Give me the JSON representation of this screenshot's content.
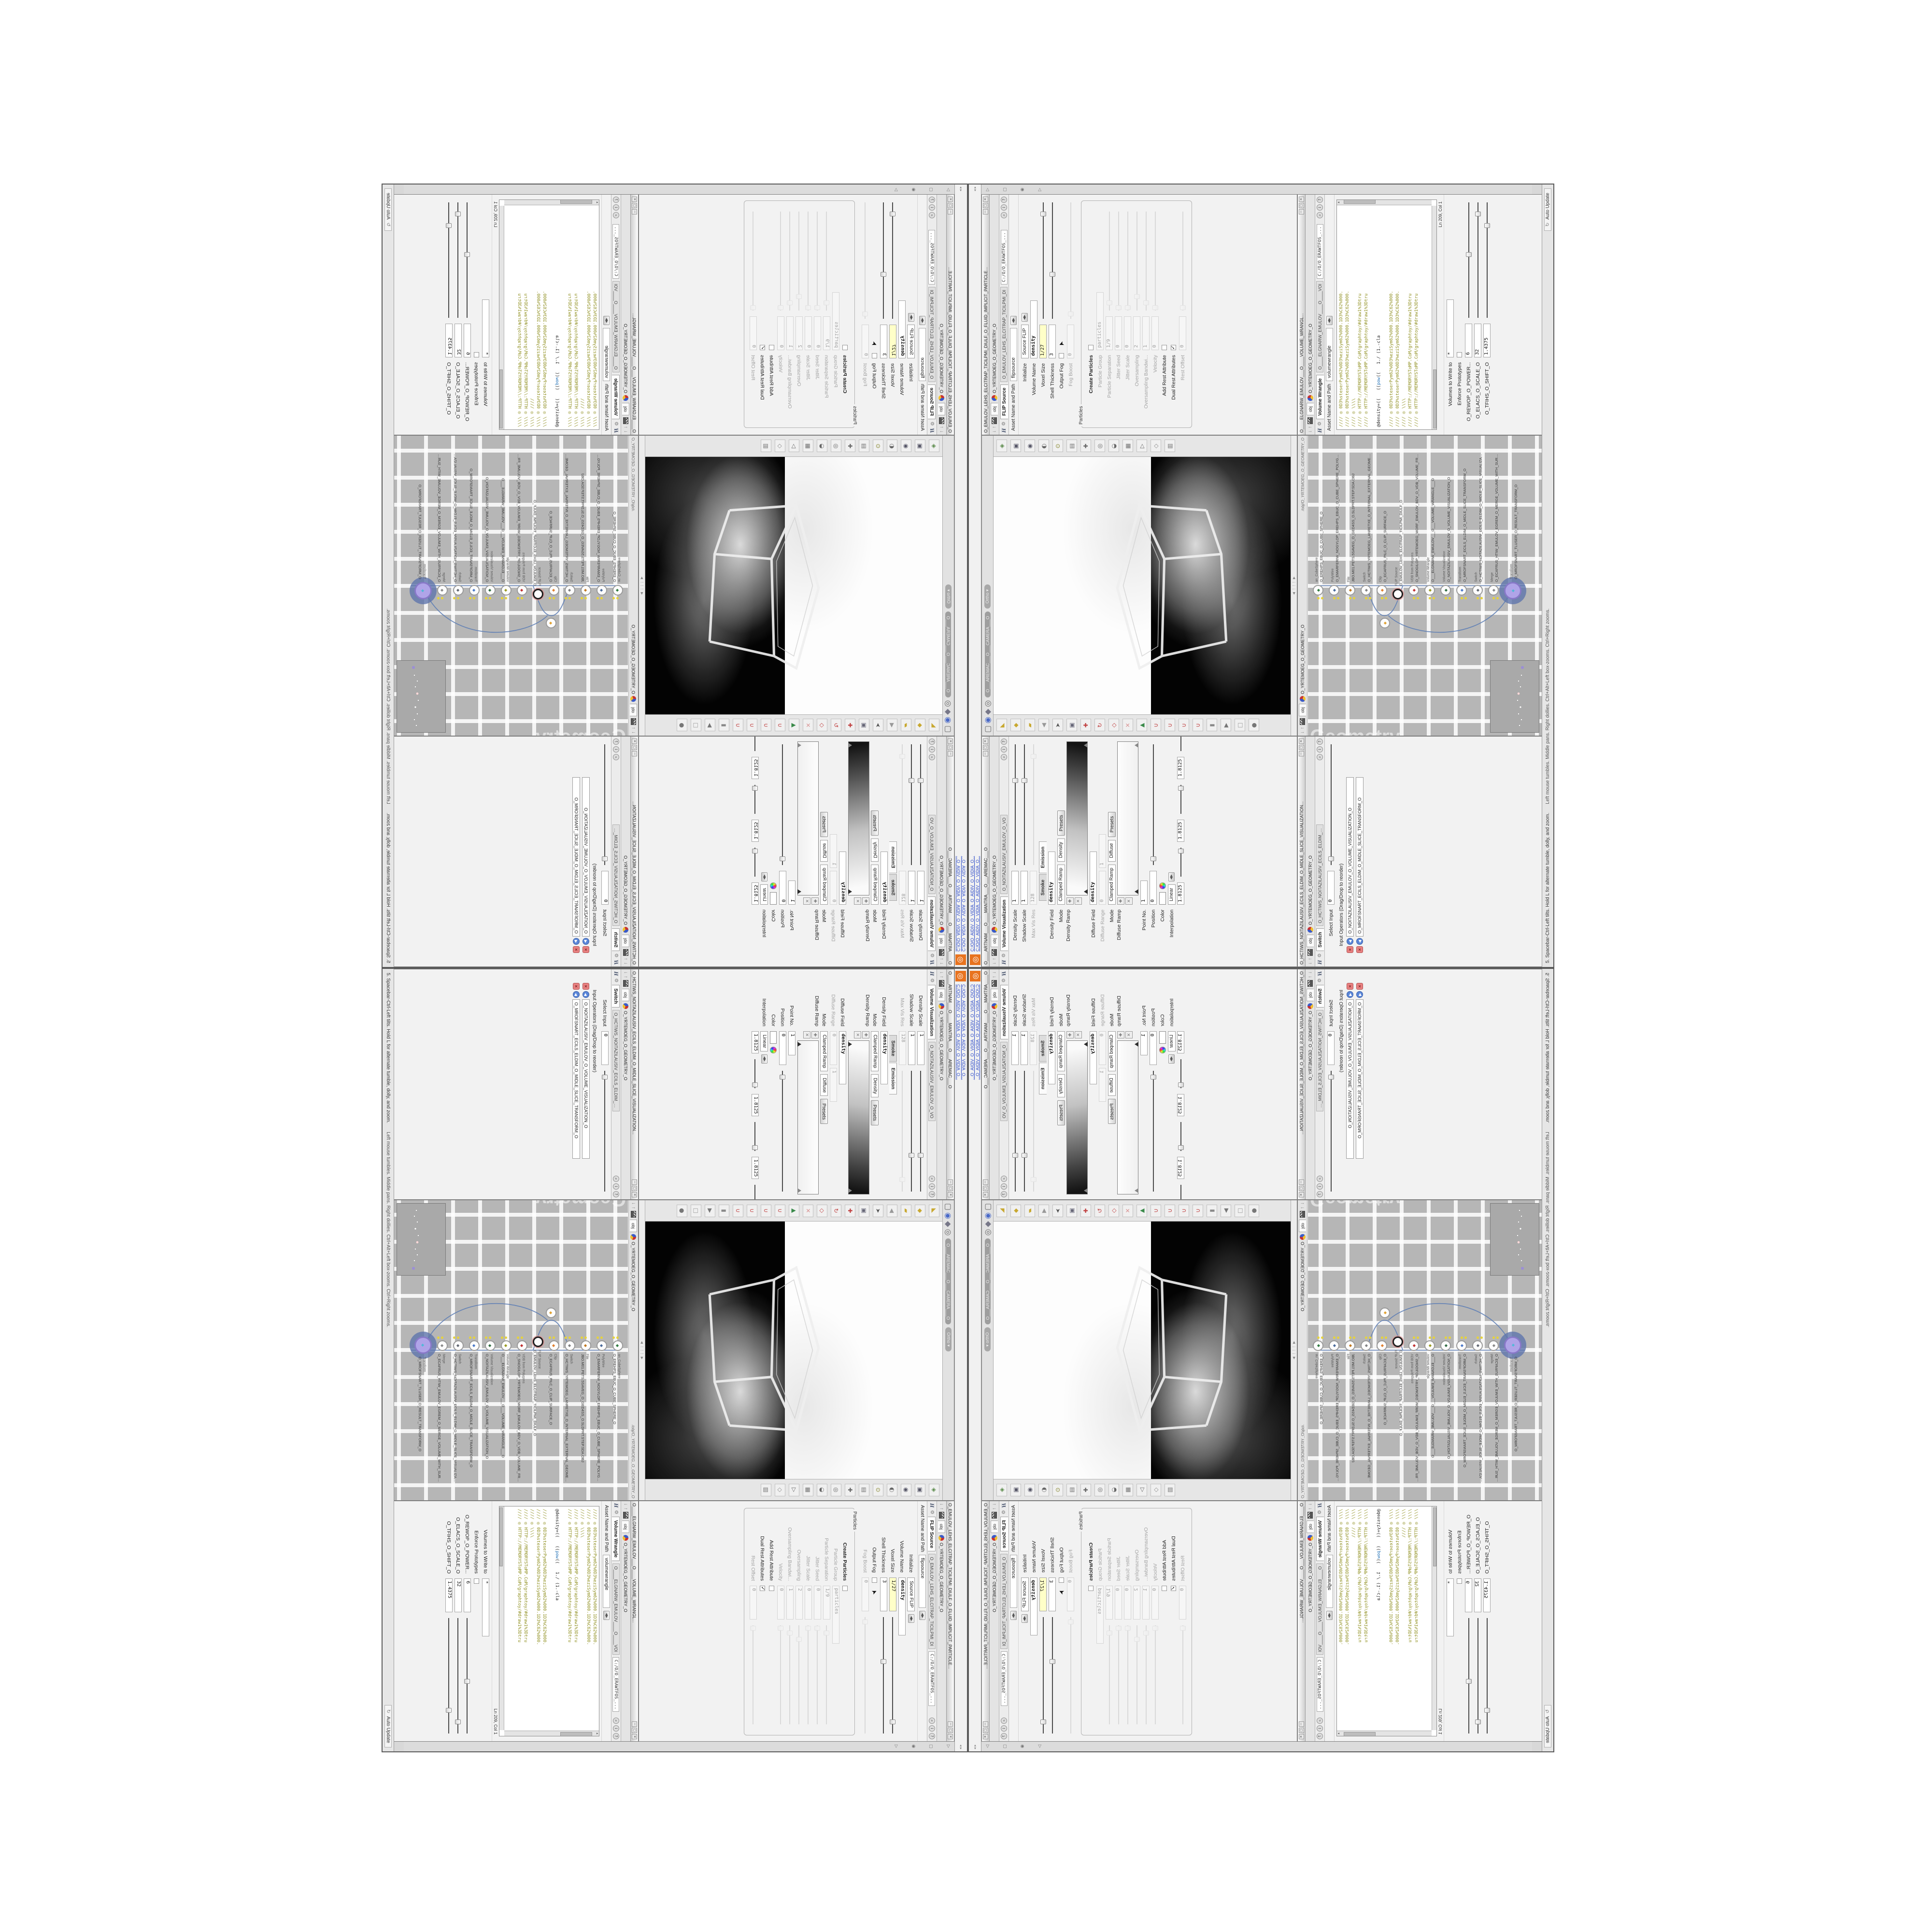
{
  "app": {
    "logo_glyph": "◎",
    "top_links": [
      "C:/O/O_AIDIV_O_VIDIA_O_AIDIV_O_VIDIA_O...",
      "C:/O/O_AIDIV_O_VIDIA_O_AIDIV_O_VIDIA_O..."
    ],
    "splitters": "◂ ▸",
    "sidebar_icons": [
      {
        "n": "collapse-arrow-icon",
        "g": "▷"
      },
      {
        "n": "panel-icon",
        "g": "▢"
      },
      {
        "n": "pin-icon",
        "g": "◉"
      },
      {
        "n": "tray-arrow-icon",
        "g": "▷"
      }
    ],
    "status_left": "5. Spacebar-Ctrl-Left tilts. Hold L for alternate tumble, dolly, and zoom.",
    "status_mid": "Left mouse tumbles. Middle pans. Right dollies. Ctrl+Alt+Left box-zooms. Ctrl+Right zooms.",
    "auto_update": "Auto Update",
    "window_buttons": [
      "─",
      "▢",
      "✕"
    ]
  },
  "common": {
    "obj_tab": "obj",
    "geo_path": "O_YRTEMOEG_O_GEOMETRY_O",
    "asset_label": "Asset Name and Path",
    "softpath": "C:/O/O_ERAWTFOS_..."
  },
  "colors": {
    "accent_orange": "#e8731f",
    "link_blue": "#2a49c8",
    "code_olive": "#8f8f1f",
    "code_blue": "#1f6fb5",
    "wire_blue": "#5f7fb5",
    "node_purple": "#b0a4e8",
    "flag_yellow": "#e6d23c",
    "magnet_red": "#c04040",
    "network_grey": "#b6b6b6",
    "keyframe_yellow": "#ffffc8"
  },
  "flip": {
    "title": "O_EMULOV_LEHS_ELCITRAP_TICILPMI_DIULF_O_FLUID_IMPLICIT_PARTICLE...",
    "tab": "FLIP Source",
    "tab2": "O_EMULOV_LEHS_ELCITRAP_TICILPMI_DI",
    "asset": "flipsource",
    "group": "Particles",
    "rows": [
      {
        "l": "Initialize",
        "t": "m",
        "v": "Source FLIP"
      },
      {
        "l": "Volume Name",
        "t": "f",
        "v": "density",
        "bold": 1,
        "w": 120
      },
      {
        "l": "Voxel Size",
        "t": "f",
        "v": "1/27",
        "y": 1,
        "w": 70,
        "s": 90
      },
      {
        "l": "Shell Thickness",
        "t": "f",
        "v": "3",
        "w": 70,
        "s": 38
      },
      {
        "l": "Output Fog",
        "t": "c",
        "v": "",
        "cursor": 1
      },
      {
        "l": "Fog Boost",
        "t": "f",
        "v": "0",
        "d": 1,
        "w": 70,
        "s": 4
      }
    ],
    "prows": [
      {
        "l": "Create Particles",
        "t": "c",
        "v": "",
        "boldlabel": 1
      },
      {
        "l": "Particle Group",
        "t": "f",
        "v": "particles",
        "d": 1,
        "w": 120
      },
      {
        "l": "Particle Separation",
        "t": "f",
        "v": "1/9",
        "d": 1,
        "w": 70,
        "s": 8
      },
      {
        "l": "Jitter Seed",
        "t": "f",
        "v": "0",
        "d": 1,
        "w": 70,
        "s": 3
      },
      {
        "l": "Jitter Scale",
        "t": "f",
        "v": "0",
        "d": 1,
        "w": 70,
        "s": 3
      },
      {
        "l": "Oversampling",
        "t": "f",
        "v": "2",
        "d": 1,
        "w": 70,
        "s": 14
      },
      {
        "l": "Oversampling Bandwi...",
        "t": "f",
        "v": "1",
        "d": 1,
        "w": 70,
        "s": 8
      },
      {
        "l": "Velocity",
        "t": "f",
        "v": "0",
        "d": 1,
        "w": 70,
        "s": 3
      },
      {
        "l": "Add Rest Attribute",
        "t": "c",
        "v": ""
      },
      {
        "l": "Dual Rest Attributes",
        "t": "c",
        "v": "1"
      },
      {
        "l": "Rest Offset",
        "t": "f",
        "v": "0",
        "d": 1,
        "w": 70,
        "s": 3
      }
    ]
  },
  "volviz": {
    "title": "O____ARTNAM___O____MANTRA___O___AREMAC___O",
    "tab": "Volume Visualization",
    "tab2": "O_NOITAZILAUSIV_EMULOV_O_VO",
    "rows": [
      {
        "l": "Density Scale",
        "t": "f",
        "v": "1",
        "w": 70,
        "s": 70
      },
      {
        "l": "Shadow Scale",
        "t": "f",
        "v": "1",
        "w": 70,
        "s": 70
      },
      {
        "l": "Max Vis Res",
        "t": "f",
        "v": "128",
        "d": 1,
        "w": 70,
        "s": 90
      },
      {
        "l": "",
        "t": "tabs",
        "tabs": [
          "Smoke",
          "Emission"
        ],
        "active": 1
      },
      {
        "l": "Density Field",
        "t": "f",
        "v": "density",
        "bold": 1,
        "w": 110
      },
      {
        "l": "Mode",
        "t": "mm",
        "v": "Clamped Ramp",
        "v2": "Density",
        "b": "Presets"
      },
      {
        "l": "Density Ramp",
        "t": "ramp",
        "dark": 1
      },
      {
        "l": "Diffuse Field",
        "t": "f",
        "v": "density",
        "bold": 1,
        "w": 110
      },
      {
        "l": "Diffuse Range",
        "t": "ff",
        "v": "0",
        "v2": "1",
        "d": 1
      },
      {
        "l": "Mode",
        "t": "mm",
        "v": "Clamped Ramp",
        "v2": "Diffuse",
        "b": "Presets"
      },
      {
        "l": "Diffuse Ramp",
        "t": "ramp",
        "dark": 0
      },
      {
        "l": "Point No.",
        "t": "f",
        "v": "1",
        "w": 50
      },
      {
        "l": "Position",
        "t": "f",
        "v": "0",
        "w": 70,
        "s": 5
      },
      {
        "l": "Color",
        "t": "color"
      },
      {
        "l": "Interpolation",
        "t": "m",
        "v": "Linear"
      },
      {
        "l": "",
        "t": "fff",
        "v": "1.8125",
        "v2": "1.8125",
        "v3": "1.8125"
      }
    ]
  },
  "switchp": {
    "title": "O_HCTIWS_NOITAZILAUSIV_ECILS_ELDIM_O_MIDLE_SLICE_VISUALIZATION...",
    "tab": "Switch",
    "tab2": "O_HCTIWS_NOITAZILAUSIV_ECILS_ELDIM_O_",
    "rows": [
      {
        "l": "Select Input",
        "t": "f",
        "v": "0",
        "w": 70,
        "s": 5
      }
    ],
    "list_label": "Input Operators (Drag/Drop to reorder)",
    "items": [
      "O_NOITAZILAUSIV_EMULOV_O_VOLUME_VISUALIZATION_O",
      "O_MROFSNART_ECILS_ELDIM_O_MIDLE_SLICE_TRANSFORM_O"
    ]
  },
  "wrangle": {
    "title": "O____ELGNARW_EMULOV___O____VOLUME_WRANGL...",
    "tab": "Volume Wrangle",
    "tab2": "O____ELGNARW_EMULOV____O____VOl",
    "asset": "volumewrangle",
    "status": "Ln 209, Col 1",
    "code": [
      [
        {
          "t": "//// ◎ 0D3%steserPym62%0D3%eziSym62%000.1D3%C62%000.",
          "c": "o"
        }
      ],
      [
        {
          "t": "//// ◎ 0D3%steserPym62%0D3%eziSym62%000.1D3%C62%000.",
          "c": "o"
        }
      ],
      [
        {
          "t": "//// ◎ \\\\\\\\",
          "c": "o"
        }
      ],
      [
        {
          "t": "//// ◎ HTTP://MEMORYST◎MP.C◎M/graphtoy/#draw1%3Dtru",
          "c": "o"
        }
      ],
      [
        {
          "t": "//// ◎ HTTP://MEMORYST◎MP.C◎M/graphtoy/#draw1%3Dtru",
          "c": "o"
        }
      ],
      [],
      [
        {
          "t": "@density=((   ((",
          "c": "k"
        },
        {
          "t": "pow",
          "c": "b"
        },
        {
          "t": "((   1./ (1.-cla",
          "c": "k"
        }
      ],
      [],
      [
        {
          "t": "//// ◎ 0D3%steserPym62%0D3%eziSym62%000.1D3%C62%000.",
          "c": "o"
        }
      ],
      [
        {
          "t": "//// ◎ 0D3%steserPym62%0D3%eziSym62%000.1D3%C62%000.",
          "c": "o"
        }
      ],
      [
        {
          "t": "//// ◎ \\\\\\\\",
          "c": "o"
        }
      ],
      [
        {
          "t": "//// ◎ HTTP://MEMORYST◎MP.C◎M/graphtoy/#draw1%3Dtru",
          "c": "o"
        }
      ],
      [
        {
          "t": "//// ◎ HTTP://MEMORYST◎MP.C◎M/graphtoy/#draw1%3Dtru",
          "c": "o"
        }
      ]
    ],
    "rows": [
      {
        "l": "Volumes to Write to",
        "t": "f",
        "v": "*",
        "w": 120
      },
      {
        "l": "Enforce Prototypes",
        "t": "c",
        "v": ""
      },
      {
        "l": "O_REWOP_O_POWER...",
        "t": "f",
        "v": "6",
        "w": 70,
        "s": 55
      },
      {
        "l": "O_ELACS_O_SCALE_O",
        "t": "f",
        "v": "32",
        "w": 70,
        "s": 90
      },
      {
        "l": "O_TFIHS_O_SHIFT_O",
        "t": "f",
        "v": "1.4375",
        "w": 70,
        "s": 80
      }
    ]
  },
  "viewport": {
    "camera_pill": "O___AREMAC___O___CAMERA___O",
    "ortho_pill": "Ortho ▾",
    "path": "/obj/O_YRTEMOEG_O_GEOMETRY_O",
    "top_icons": [
      {
        "n": "layout-icon",
        "g": "▢",
        "c": "#666"
      },
      {
        "n": "world-icon",
        "g": "◉",
        "c": "#4a6ac8"
      },
      {
        "n": "box-view-icon",
        "g": "◆",
        "c": "#778"
      },
      {
        "n": "target-icon",
        "g": "◎",
        "c": "#666"
      }
    ],
    "right_icons": [
      {
        "n": "select-mode-icon",
        "g": "◈",
        "c": "#5a8a4a"
      },
      {
        "n": "shade-box-icon",
        "g": "▣",
        "c": "#555566"
      },
      {
        "n": "lock-view-icon",
        "g": "◉",
        "c": "#555566"
      },
      {
        "n": "half-shade-icon",
        "g": "◐",
        "c": "#666"
      },
      {
        "n": "light-icon",
        "g": "⊙",
        "c": "#888830"
      },
      {
        "n": "grid-icon",
        "g": "▤",
        "c": "#777"
      },
      {
        "n": "crosshair-icon",
        "g": "✚",
        "c": "#666"
      },
      {
        "n": "circle-tool-icon",
        "g": "◎",
        "c": "#666"
      },
      {
        "n": "clip-plane-icon",
        "g": "◒",
        "c": "#666"
      },
      {
        "n": "mesh-icon",
        "g": "▦",
        "c": "#777"
      },
      {
        "n": "play-icon",
        "g": "▷",
        "c": "#666"
      },
      {
        "n": "diamond-tool-icon",
        "g": "◇",
        "c": "#888"
      },
      {
        "n": "rows-icon",
        "g": "▥",
        "c": "#777"
      }
    ],
    "left_icons": [
      {
        "n": "lasso-tool-icon",
        "g": "◣",
        "c": "#c8a830"
      },
      {
        "n": "select-diamond-icon",
        "g": "◆",
        "c": "#c8a830"
      },
      {
        "n": "paint-tool-icon",
        "g": "▰",
        "c": "#c8a830"
      },
      {
        "n": "back-arrow-icon",
        "g": "◀",
        "c": "#999"
      },
      {
        "n": "cursor-tool-icon",
        "g": "➤",
        "c": "#555"
      },
      {
        "n": "camera-box-icon",
        "g": "▣",
        "c": "#667"
      },
      {
        "n": "move-tool-icon",
        "g": "✚",
        "c": "#c04040"
      },
      {
        "n": "rotate-tool-icon",
        "g": "↻",
        "c": "#c04040"
      },
      {
        "n": "scale-tool-icon",
        "g": "◇",
        "c": "#c04040"
      },
      {
        "n": "pose-tool-icon",
        "g": "✕",
        "c": "#d89090"
      },
      {
        "n": "axis-triad-icon",
        "g": "▲",
        "c": "#3a8a4a"
      },
      {
        "n": "snap-grid-magnet-icon",
        "g": "∪",
        "c": "#c04040"
      },
      {
        "n": "snap-point-magnet-icon",
        "g": "∪",
        "c": "#c04040"
      },
      {
        "n": "snap-edge-magnet-icon",
        "g": "∪",
        "c": "#c04040"
      },
      {
        "n": "snap-prim-magnet-icon",
        "g": "∪",
        "c": "#c04040"
      },
      {
        "n": "divider-icon",
        "g": "▮",
        "c": "#888"
      },
      {
        "n": "play-small-icon",
        "g": "▶",
        "c": "#777"
      },
      {
        "n": "notes-icon",
        "g": "□",
        "c": "#999"
      },
      {
        "n": "sphere-small-icon",
        "g": "●",
        "c": "#777"
      }
    ]
  },
  "network": {
    "watermark": "Geometry",
    "path": "/obj/O_YRTEMOEG_O_GEOMETRY_O",
    "nodes": [
      {
        "t": "an_CubeSphere",
        "n": "O_EREHPS_EBUC_O_CUBE_SPHERE_O",
        "c": "#2f7a3f",
        "flag": 1
      },
      {
        "t": "PolyWire",
        "n": "O_EMARFERIW_NOGYLOP_EREHPS_EBUC_O_CUBE_SPHERE_POLYGON_WIREFRAME_O",
        "c": "#4a6a9a",
        "flag": 1
      },
      {
        "t": "File",
        "n": "JBO.M01.PETS.5SAVEG_O_GED4SS_O.SLDPRT.STEP.SDA.OBJ",
        "c": "#c07820",
        "flag": 1
      },
      {
        "t": "Switch",
        "n": "O_HCTIWS_YRTEMOEG_LANRETXE_O_INTERNAL_EXTERNAL_GEOMETRY_SWITCH_O",
        "c": "#808080",
        "flag": 1
      },
      {
        "t": "Clip",
        "n": "O_ECAFRUS_PILC_O_CLIP_SURFACE_O",
        "c": "#e08030",
        "flag": 1,
        "sidemate": 1
      },
      {
        "t": "FLIP Source",
        "n": "O_EMULOV_LEHS_ELCITRAP_TICILPMI_DIULF_O",
        "ring": 1,
        "c": "#ffffff"
      },
      {
        "t": "VDB from Polygons",
        "n": "O_SNOGILOP_YRTEMOEG_MORF_EMULOV_BDV_O_VDB_VOLUME_FROM_GEOMETRY_P...",
        "c": "#c03030",
        "flag": 1
      },
      {
        "t": "Volume Wrangle",
        "n": "O___ELGNARW_EMULOV___O___VOLUME_WRANGLE___O",
        "c": "#9a9a20",
        "flag": 1
      },
      {
        "t": "Volume Visualization",
        "n": "O_NOITAZILAUSIV_EMULOV_O_VOLUME_VISUALIZATION_O",
        "c": "#2f6a3f",
        "flag": 1
      },
      {
        "t": "Transform",
        "n": "O_MROFSNART_ECILS_ELDIM_O_MIDLE_SLICE_TRANSFORM_O",
        "c": "#4a78c8",
        "flag": 1
      },
      {
        "t": "Switch",
        "n": "O_HCTIWS_NOITAZILAUSIV_ECILS_ELDIM_O_MIDLE_SLICE_VISUALIZATION_SWITCH_O",
        "c": "#606670",
        "flag": 1
      },
      {
        "t": "Merge",
        "n": "O_ECAFRUS_HTIW_EMULOV_EGREM_O_MERGE_VOLUME_WITH_SURFACE_O",
        "c": "#888888",
        "flag": 1
      },
      {
        "t": "Transform",
        "n": "O_MROFSNART_TLUSER_O_RESULT_TRANSFORM_O",
        "c": "#50b8d8",
        "big": 1
      }
    ],
    "side_node": {
      "t": "Clip",
      "n": "O_PILC_O",
      "c": "#e0a030"
    }
  }
}
